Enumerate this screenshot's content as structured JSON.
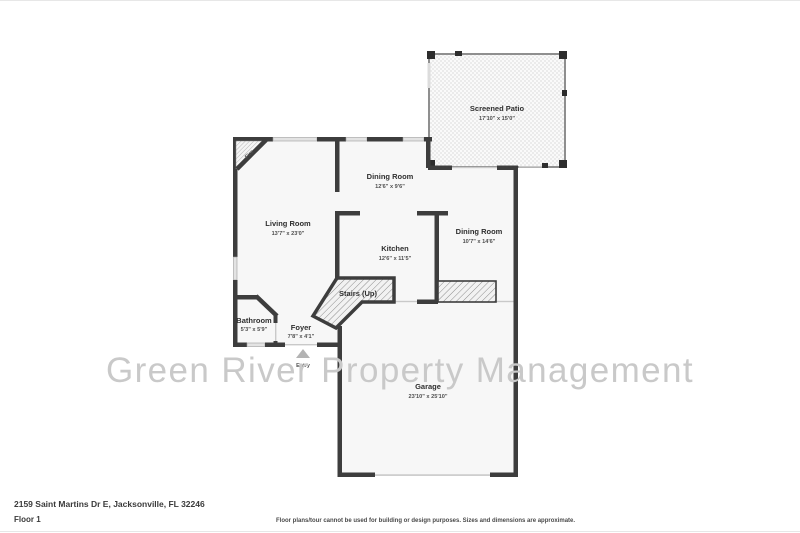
{
  "watermark": "Green River Property Management",
  "footer": {
    "address": "2159 Saint Martins Dr E, Jacksonville, FL 32246",
    "floor": "Floor 1",
    "disclaimer": "Floor plans/tour cannot be used for building or design purposes. Sizes and dimensions are approximate."
  },
  "floor_plan": {
    "rooms": [
      {
        "name": "Screened Patio",
        "dims": "17'10\" x 15'0\""
      },
      {
        "name": "Dining Room",
        "dims": "12'6\" x 9'6\""
      },
      {
        "name": "Living Room",
        "dims": "13'7\" x 23'0\""
      },
      {
        "name": "Kitchen",
        "dims": "12'6\" x 11'5\""
      },
      {
        "name": "Dining Room",
        "dims": "10'7\" x 14'6\""
      },
      {
        "name": "Stairs (Up)",
        "dims": ""
      },
      {
        "name": "Bathroom",
        "dims": "5'3\" x 5'9\""
      },
      {
        "name": "Foyer",
        "dims": "7'8\" x 4'1\""
      },
      {
        "name": "Garage",
        "dims": "23'10\" x 25'10\""
      }
    ],
    "annotations": {
      "fireplace": "Fire",
      "entry": "Entry"
    },
    "colors": {
      "wall": "#3d3d3d",
      "floor_fill": "#f7f7f7",
      "patio_screen": "#8f8f8f",
      "watermark": "#c9c9c9"
    }
  }
}
